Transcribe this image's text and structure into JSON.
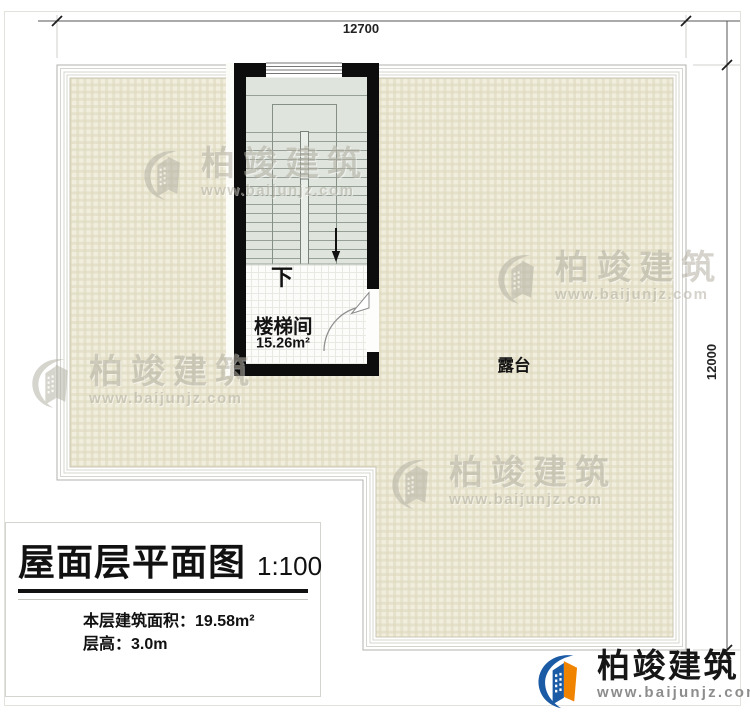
{
  "dimensions": {
    "width": "12700",
    "height": "12000"
  },
  "rooms": {
    "stairwell": {
      "label": "楼梯间",
      "area": "15.26m²",
      "direction": "下"
    },
    "terrace": {
      "label": "露台"
    }
  },
  "title_block": {
    "title": "屋面层平面图",
    "scale": "1:100",
    "area_label": "本层建筑面积：",
    "area_value": "19.58m²",
    "height_label": "层高：",
    "height_value": "3.0m"
  },
  "brand": {
    "name": "柏竣建筑",
    "url": "www.baijunjz.com"
  },
  "colors": {
    "wall": "#0d0d0d",
    "terrace_bg": "#f1eedd",
    "terrace_grid_line": "#ddd9c0",
    "stair_bg": "#dfe4dd",
    "brand_blue": "#1b5aa5",
    "brand_orange": "#f08300",
    "watermark_gray": "#b6b3a6"
  }
}
